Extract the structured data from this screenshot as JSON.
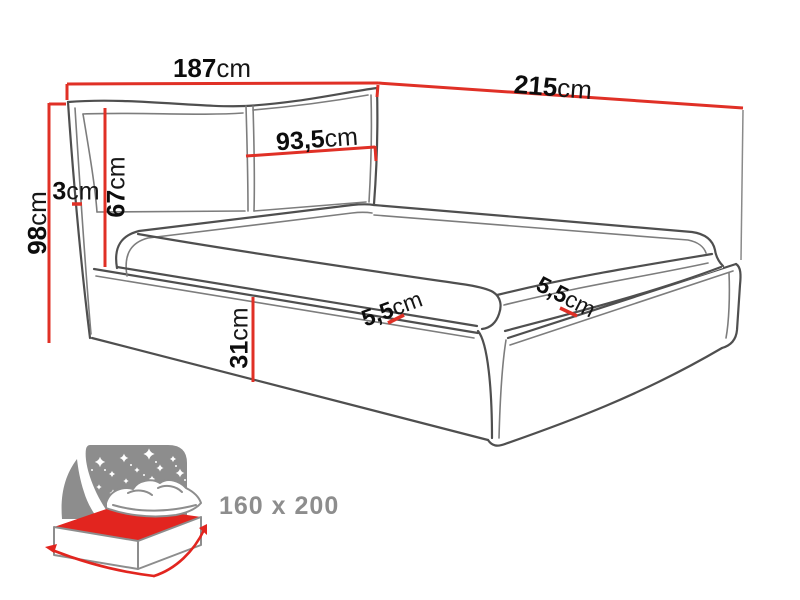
{
  "diagram": {
    "title_hint": "upholstered-bed-dimension-drawing",
    "labels": {
      "headboard_width": {
        "value": "187",
        "unit": "cm"
      },
      "bed_length": {
        "value": "215",
        "unit": "cm"
      },
      "total_height": {
        "value": "98",
        "unit": "cm"
      },
      "headboard_height": {
        "value": "67",
        "unit": "cm"
      },
      "headboard_side_gap": {
        "value": "3",
        "unit": "cm"
      },
      "headboard_half_width": {
        "value": "93,5",
        "unit": "cm"
      },
      "frame_height": {
        "value": "31",
        "unit": "cm"
      },
      "mattress_edge_front": {
        "value": "5,5",
        "unit": "cm"
      },
      "mattress_edge_side": {
        "value": "5,5",
        "unit": "cm"
      }
    },
    "colors": {
      "dimension_red": "#e03026",
      "line_gray": "#4f4f4f",
      "line_light_gray": "#7d7d7d",
      "icon_gray": "#8d8d8d",
      "icon_red": "#e2251f"
    }
  },
  "size_badge": {
    "label": "160 x 200"
  }
}
